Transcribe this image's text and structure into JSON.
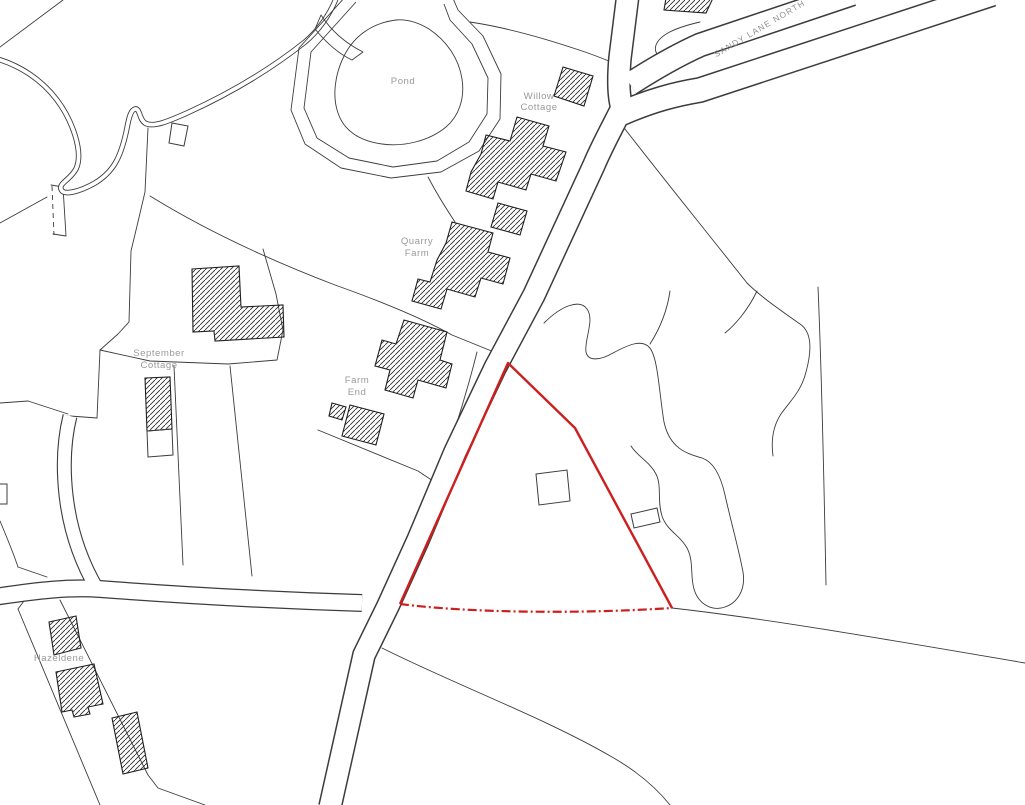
{
  "map": {
    "place_labels": {
      "pond": "Pond",
      "willow_cottage_line1": "Willow",
      "willow_cottage_line2": "Cottage",
      "quarry_farm_line1": "Quarry",
      "quarry_farm_line2": "Farm",
      "farm_end_line1": "Farm",
      "farm_end_line2": "End",
      "september_cottage_line1": "September",
      "september_cottage_line2": "Cottage",
      "hazeldene": "Hazeldene",
      "road_name": "SANDY LANE NORTH"
    },
    "colors": {
      "background": "#ffffff",
      "map_lines": "#3c3c3c",
      "labels": "#9a9a9a",
      "site_boundary_red": "#cc1f1f"
    }
  }
}
